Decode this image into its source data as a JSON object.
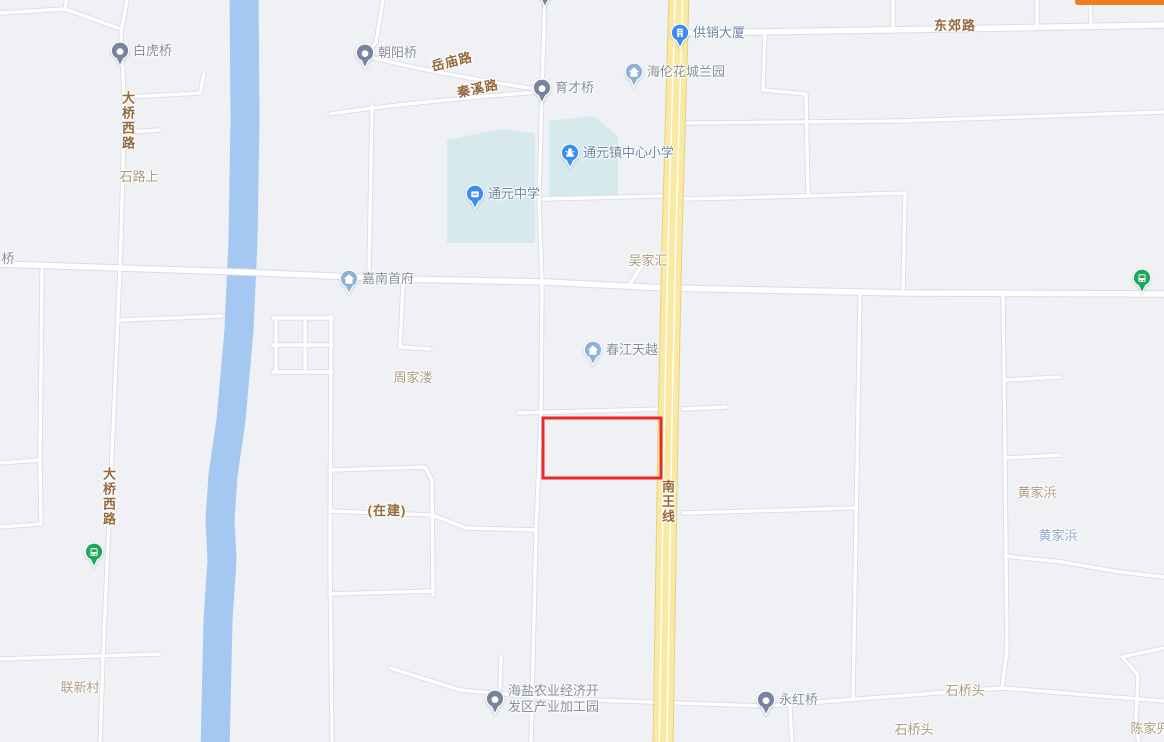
{
  "app": {
    "cut_off_button_color": "#ee7d1b"
  },
  "map": {
    "theme": {
      "background": "#eff1f5",
      "road_fill": "#ffffff",
      "road_casing": "#d9dce3",
      "river": "#a4c8f1",
      "campus_area": "#d6eaee",
      "highway_fill": "#f9e9a3",
      "highway_casing": "#e7d27d",
      "highway_stripe": "#ffffff",
      "selection_red": "#e8282d",
      "pin_slate": "#78849f",
      "pin_lightblue": "#8fb1d7",
      "pin_blue": "#3d8cf0",
      "pin_green": "#1fa85c",
      "label_road_brown": "#94683c",
      "label_village_tan": "#ab9a7c",
      "label_water_blue": "#8ba7cb",
      "label_poi_gray": "#878d97",
      "label_poi_blue": "#6e86a3"
    },
    "selection_rectangle": {
      "x": 543,
      "y": 418,
      "width": 118,
      "height": 60
    },
    "markers": [
      {
        "id": "baihuqiao",
        "label": "白虎桥",
        "x": 120,
        "y": 52,
        "shape": "pin",
        "color_key": "pin_slate",
        "icon": "bridge-dot-icon",
        "label_style": "poi"
      },
      {
        "id": "chaoyangqiao",
        "label": "朝阳桥",
        "x": 365,
        "y": 54,
        "shape": "pin",
        "color_key": "pin_slate",
        "icon": "bridge-dot-icon",
        "label_style": "poi"
      },
      {
        "id": "yucai-beiqiao",
        "label": "育才北桥",
        "x": 545,
        "y": -7,
        "shape": "pin",
        "color_key": "pin_slate",
        "icon": "bridge-dot-icon",
        "label_style": "poi"
      },
      {
        "id": "yucaiqiao",
        "label": "育才桥",
        "x": 542,
        "y": 89,
        "shape": "pin",
        "color_key": "pin_slate",
        "icon": "bridge-dot-icon",
        "label_style": "poi"
      },
      {
        "id": "gongxiao-dasha",
        "label": "供销大厦",
        "x": 680,
        "y": 34,
        "shape": "round",
        "color_key": "pin_blue",
        "icon": "building-icon",
        "label_style": "poi_blue"
      },
      {
        "id": "hailun-huacheng-lanyuan",
        "label": "海伦花城兰园",
        "x": 634,
        "y": 73,
        "shape": "round",
        "color_key": "pin_lightblue",
        "icon": "house-icon",
        "label_style": "poi"
      },
      {
        "id": "tongyuanzhen-zhongxin-xiaoxue",
        "label": "通元镇中心小学",
        "x": 570,
        "y": 154,
        "shape": "round",
        "color_key": "pin_blue",
        "icon": "student-icon",
        "label_style": "poi_blue"
      },
      {
        "id": "tongyuan-zhongxue",
        "label": "通元中学",
        "x": 475,
        "y": 195,
        "shape": "round",
        "color_key": "pin_blue",
        "icon": "school-book-icon",
        "label_style": "poi_blue"
      },
      {
        "id": "jianan-shoufu",
        "label": "嘉南首府",
        "x": 349,
        "y": 280,
        "shape": "round",
        "color_key": "pin_lightblue",
        "icon": "house-icon",
        "label_style": "poi"
      },
      {
        "id": "chunjiang-tianyue",
        "label": "春江天越",
        "x": 593,
        "y": 351,
        "shape": "round",
        "color_key": "pin_lightblue",
        "icon": "house-icon",
        "label_style": "poi"
      },
      {
        "id": "yonghongqiao",
        "label": "永红桥",
        "x": 766,
        "y": 701,
        "shape": "pin",
        "color_key": "pin_slate",
        "icon": "bridge-dot-icon",
        "label_style": "poi"
      },
      {
        "id": "haiyan-agri-industrial-park",
        "label": "海盐农业经济开发区产业加工园",
        "lines": [
          "海盐农业经济开",
          "发区产业加工园"
        ],
        "x": 495,
        "y": 700,
        "shape": "pin",
        "color_key": "pin_slate",
        "icon": "bridge-dot-icon",
        "label_style": "poi"
      },
      {
        "id": "bus-stop-west",
        "label": "",
        "x": 94,
        "y": 553,
        "shape": "round",
        "color_key": "pin_green",
        "icon": "bus-icon",
        "label_style": "poi"
      },
      {
        "id": "bus-stop-east",
        "label": "",
        "x": 1142,
        "y": 279,
        "shape": "round",
        "color_key": "pin_green",
        "icon": "bus-icon",
        "label_style": "poi"
      }
    ],
    "labels": [
      {
        "id": "daqiao-xilu-north",
        "text": "大桥西路",
        "x": 127,
        "y": 121,
        "kind": "road",
        "vertical": true
      },
      {
        "id": "shilushang",
        "text": "石路上",
        "x": 139,
        "y": 177,
        "kind": "village"
      },
      {
        "id": "yuemiaolu",
        "text": "岳庙路",
        "x": 452,
        "y": 62,
        "kind": "road",
        "rotate": -14
      },
      {
        "id": "qinxilu",
        "text": "秦溪路",
        "x": 478,
        "y": 89,
        "kind": "road",
        "rotate": -12
      },
      {
        "id": "dongjiaolu",
        "text": "东郊路",
        "x": 955,
        "y": 26,
        "kind": "road"
      },
      {
        "id": "wujiahui",
        "text": "吴家汇",
        "x": 648,
        "y": 261,
        "kind": "village"
      },
      {
        "id": "zhoujialou",
        "text": "周家溇",
        "x": 413,
        "y": 378,
        "kind": "village"
      },
      {
        "id": "under-construction",
        "text": "(在建)",
        "x": 387,
        "y": 511,
        "kind": "road"
      },
      {
        "id": "nanwangxian",
        "text": "南王线",
        "x": 667,
        "y": 502,
        "kind": "road",
        "vertical": true
      },
      {
        "id": "daqiao-xilu-south",
        "text": "大桥西路",
        "x": 108,
        "y": 497,
        "kind": "road",
        "vertical": true
      },
      {
        "id": "huangjiabang-village",
        "text": "黄家浜",
        "x": 1037,
        "y": 493,
        "kind": "village"
      },
      {
        "id": "huangjiabang-water",
        "text": "黄家浜",
        "x": 1058,
        "y": 536,
        "kind": "water"
      },
      {
        "id": "lianxincun",
        "text": "联新村",
        "x": 80,
        "y": 688,
        "kind": "village"
      },
      {
        "id": "shiqiaotou-north",
        "text": "石桥头",
        "x": 965,
        "y": 691,
        "kind": "village"
      },
      {
        "id": "shiqiaotou-south",
        "text": "石桥头",
        "x": 914,
        "y": 730,
        "kind": "village"
      },
      {
        "id": "chenjiadou",
        "text": "陈家兜",
        "x": 1150,
        "y": 729,
        "kind": "village"
      },
      {
        "id": "qiao-partial",
        "text": "桥",
        "x": 8,
        "y": 259,
        "kind": "poi_gray"
      }
    ]
  }
}
